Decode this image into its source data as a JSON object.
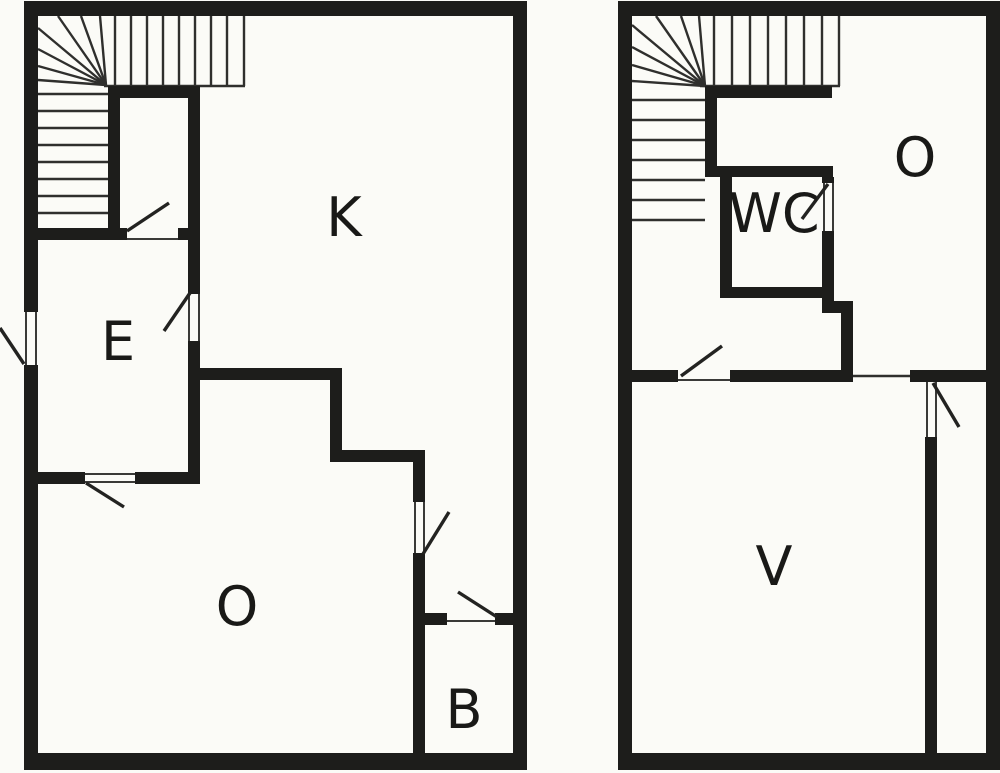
{
  "colors": {
    "background": "#fbfbf7",
    "wall": "#1d1d1b",
    "thin_line": "#2f2f2d",
    "label": "#191917"
  },
  "floor_plans": [
    {
      "id": "floor-plan-left",
      "rooms": [
        {
          "label": "K",
          "x": 344,
          "y": 218
        },
        {
          "label": "E",
          "x": 118,
          "y": 342
        },
        {
          "label": "O",
          "x": 237,
          "y": 607
        },
        {
          "label": "B",
          "x": 464,
          "y": 710
        }
      ],
      "walls": [
        {
          "name": "outer-wall-top",
          "r": [
            24,
            1,
            503,
            15
          ]
        },
        {
          "name": "outer-wall-bottom",
          "r": [
            24,
            753,
            503,
            17
          ]
        },
        {
          "name": "outer-wall-left",
          "r": [
            24,
            1,
            14,
            769
          ]
        },
        {
          "name": "outer-wall-right",
          "r": [
            513,
            1,
            14,
            769
          ]
        },
        {
          "name": "stair-closet-top-wall",
          "r": [
            108,
            86,
            92,
            12
          ]
        },
        {
          "name": "closet-west-wall",
          "r": [
            108,
            86,
            12,
            154
          ]
        },
        {
          "name": "closet-east-wall",
          "r": [
            188,
            86,
            12,
            398
          ]
        },
        {
          "name": "stair-bottom-wall",
          "r": [
            38,
            228,
            162,
            12
          ]
        },
        {
          "name": "e-room-south-wall",
          "r": [
            38,
            472,
            162,
            12
          ]
        },
        {
          "name": "k-o-step-wall-a",
          "r": [
            197,
            368,
            145,
            12
          ]
        },
        {
          "name": "k-o-step-wall-b",
          "r": [
            330,
            368,
            12,
            94
          ]
        },
        {
          "name": "k-o-step-wall-c",
          "r": [
            330,
            450,
            95,
            12
          ]
        },
        {
          "name": "o-b-dividing-wall",
          "r": [
            413,
            450,
            12,
            303
          ]
        },
        {
          "name": "b-room-north-wall-a",
          "r": [
            413,
            613,
            34,
            12
          ]
        },
        {
          "name": "b-room-north-wall-b",
          "r": [
            495,
            613,
            18,
            12
          ]
        }
      ],
      "doors": [
        {
          "name": "closet-door",
          "gap": [
            127,
            226,
            51,
            16
          ],
          "jambs": [
            [
              127,
              239,
              178,
              239
            ]
          ],
          "swing": [
            127,
            231,
            169,
            203
          ]
        },
        {
          "name": "entry-door",
          "gap": [
            23,
            312,
            16,
            53
          ],
          "jambs": [
            [
              26,
              312,
              26,
              365
            ],
            [
              36,
              312,
              36,
              365
            ]
          ],
          "swing": [
            24,
            364,
            0,
            328
          ]
        },
        {
          "name": "e-k-door",
          "gap": [
            187,
            294,
            14,
            47
          ],
          "jambs": [
            [
              189,
              294,
              189,
              341
            ],
            [
              199,
              294,
              199,
              341
            ]
          ],
          "swing": [
            190,
            293,
            164,
            331
          ]
        },
        {
          "name": "e-o-door",
          "gap": [
            85,
            471,
            50,
            14
          ],
          "jambs": [
            [
              85,
              474,
              135,
              474
            ],
            [
              85,
              482,
              135,
              482
            ]
          ],
          "swing": [
            86,
            483,
            124,
            507
          ]
        },
        {
          "name": "o-k-door",
          "gap": [
            412,
            502,
            14,
            51
          ],
          "jambs": [
            [
              415,
              502,
              415,
              553
            ],
            [
              424,
              502,
              424,
              553
            ]
          ],
          "swing": [
            423,
            554,
            449,
            512
          ]
        },
        {
          "name": "k-b-door",
          "gap": [
            447,
            612,
            48,
            14
          ],
          "jambs": [
            [
              447,
              621,
              495,
              621
            ]
          ],
          "swing": [
            458,
            592,
            497,
            617
          ]
        }
      ],
      "openings": [],
      "stair_lines": [
        [
          115,
          16,
          115,
          86
        ],
        [
          131,
          16,
          131,
          86
        ],
        [
          147,
          16,
          147,
          86
        ],
        [
          163,
          16,
          163,
          86
        ],
        [
          179,
          16,
          179,
          86
        ],
        [
          195,
          16,
          195,
          86
        ],
        [
          211,
          16,
          211,
          86
        ],
        [
          227,
          16,
          227,
          86
        ],
        [
          244,
          16,
          244,
          86
        ],
        [
          104,
          86,
          245,
          86
        ],
        [
          38,
          94,
          108,
          94
        ],
        [
          38,
          111,
          108,
          111
        ],
        [
          38,
          128,
          108,
          128
        ],
        [
          38,
          145,
          108,
          145
        ],
        [
          38,
          162,
          108,
          162
        ],
        [
          38,
          179,
          108,
          179
        ],
        [
          38,
          196,
          108,
          196
        ],
        [
          38,
          213,
          108,
          213
        ],
        [
          106,
          85,
          100,
          16
        ],
        [
          106,
          85,
          81,
          16
        ],
        [
          106,
          85,
          58,
          16
        ],
        [
          106,
          85,
          38,
          28
        ],
        [
          106,
          85,
          38,
          49
        ],
        [
          106,
          85,
          38,
          66
        ],
        [
          106,
          85,
          38,
          80
        ]
      ]
    },
    {
      "id": "floor-plan-right",
      "rooms": [
        {
          "label": "O",
          "x": 915,
          "y": 158
        },
        {
          "label": "WC",
          "x": 774,
          "y": 214
        },
        {
          "label": "V",
          "x": 774,
          "y": 567
        }
      ],
      "walls": [
        {
          "name": "outer-wall-top",
          "r": [
            618,
            1,
            382,
            15
          ]
        },
        {
          "name": "outer-wall-bottom",
          "r": [
            618,
            753,
            382,
            17
          ]
        },
        {
          "name": "outer-wall-left",
          "r": [
            618,
            1,
            14,
            769
          ]
        },
        {
          "name": "outer-wall-right",
          "r": [
            986,
            1,
            14,
            769
          ]
        },
        {
          "name": "stair-landing-wall",
          "r": [
            705,
            86,
            127,
            12
          ]
        },
        {
          "name": "stair-hall-wall",
          "r": [
            705,
            86,
            12,
            86
          ]
        },
        {
          "name": "wc-north-wall",
          "r": [
            705,
            166,
            128,
            11
          ]
        },
        {
          "name": "wc-west-wall",
          "r": [
            720,
            177,
            12,
            121
          ]
        },
        {
          "name": "wc-south-wall",
          "r": [
            720,
            287,
            114,
            11
          ]
        },
        {
          "name": "wc-east-wall",
          "r": [
            822,
            177,
            12,
            121
          ]
        },
        {
          "name": "step-wall-a",
          "r": [
            822,
            298,
            12,
            15
          ]
        },
        {
          "name": "step-wall-b",
          "r": [
            822,
            301,
            31,
            12
          ]
        },
        {
          "name": "step-wall-c",
          "r": [
            841,
            313,
            12,
            65
          ]
        },
        {
          "name": "main-dividing-wall-a",
          "r": [
            632,
            370,
            46,
            12
          ]
        },
        {
          "name": "main-dividing-wall-b",
          "r": [
            730,
            370,
            123,
            12
          ]
        },
        {
          "name": "main-dividing-wall-c",
          "r": [
            910,
            370,
            90,
            12
          ]
        },
        {
          "name": "v-east-wall",
          "r": [
            925,
            382,
            12,
            371
          ]
        }
      ],
      "doors": [
        {
          "name": "wc-door",
          "gap": [
            821,
            183,
            14,
            48
          ],
          "jambs": [
            [
              824,
              183,
              824,
              231
            ],
            [
              833,
              183,
              833,
              231
            ]
          ],
          "swing": [
            828,
            184,
            802,
            219
          ]
        },
        {
          "name": "hall-v-door",
          "gap": [
            678,
            369,
            52,
            14
          ],
          "jambs": [
            [
              678,
              380,
              730,
              380
            ]
          ],
          "swing": [
            681,
            376,
            722,
            346
          ]
        },
        {
          "name": "v-side-door",
          "gap": [
            924,
            382,
            14,
            55
          ],
          "jambs": [
            [
              927,
              382,
              927,
              437
            ],
            [
              936,
              382,
              936,
              437
            ]
          ],
          "swing": [
            933,
            383,
            959,
            427
          ]
        }
      ],
      "openings": [
        [
          853,
          376,
          910,
          376
        ]
      ],
      "stair_lines": [
        [
          714,
          16,
          714,
          86
        ],
        [
          732,
          16,
          732,
          86
        ],
        [
          750,
          16,
          750,
          86
        ],
        [
          768,
          16,
          768,
          86
        ],
        [
          786,
          16,
          786,
          86
        ],
        [
          804,
          16,
          804,
          86
        ],
        [
          822,
          16,
          822,
          86
        ],
        [
          839,
          16,
          839,
          86
        ],
        [
          700,
          86,
          840,
          86
        ],
        [
          632,
          100,
          705,
          100
        ],
        [
          632,
          120,
          705,
          120
        ],
        [
          632,
          140,
          705,
          140
        ],
        [
          632,
          160,
          705,
          160
        ],
        [
          632,
          180,
          705,
          180
        ],
        [
          632,
          200,
          705,
          200
        ],
        [
          632,
          220,
          705,
          220
        ],
        [
          705,
          86,
          699,
          16
        ],
        [
          705,
          86,
          681,
          16
        ],
        [
          705,
          86,
          656,
          16
        ],
        [
          705,
          86,
          632,
          25
        ],
        [
          705,
          86,
          632,
          47
        ],
        [
          705,
          86,
          632,
          65
        ],
        [
          705,
          86,
          632,
          81
        ]
      ]
    }
  ]
}
